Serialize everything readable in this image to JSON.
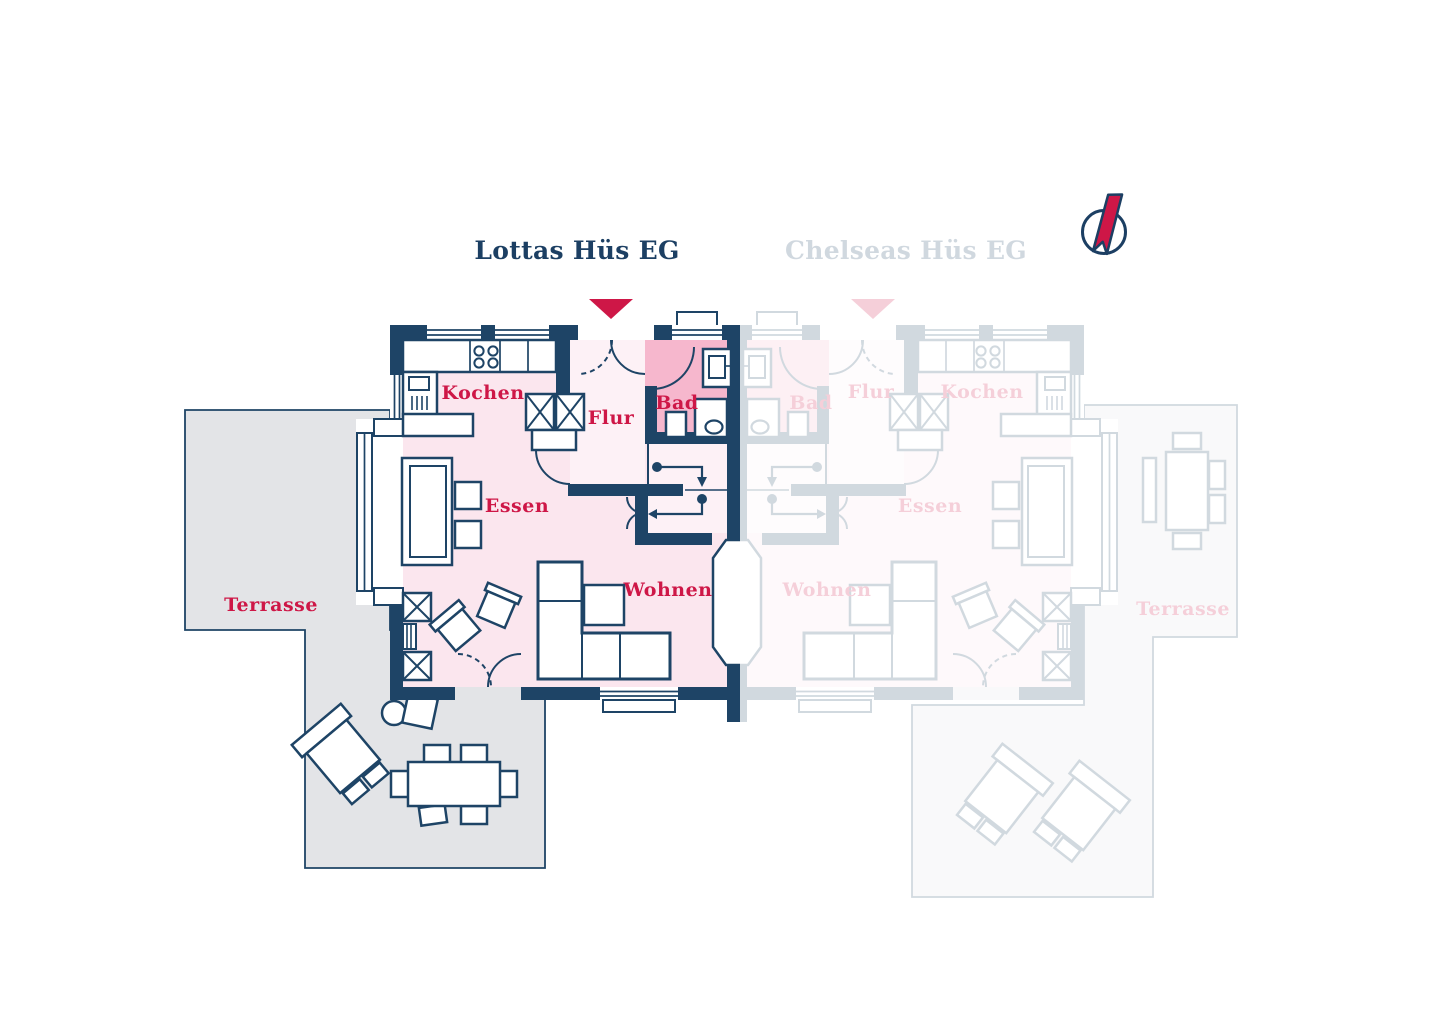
{
  "app": {
    "type": "floorplan-viewer"
  },
  "plans": [
    {
      "id": "lottas",
      "title": "Lottas Hüs EG",
      "state": "active",
      "labels": {
        "kochen": "Kochen",
        "flur": "Flur",
        "bad": "Bad",
        "essen": "Essen",
        "wohnen": "Wohnen",
        "terrasse": "Terrasse"
      }
    },
    {
      "id": "chelseas",
      "title": "Chelseas Hüs EG",
      "state": "inactive",
      "labels": {
        "kochen": "Kochen",
        "flur": "Flur",
        "bad": "Bad",
        "essen": "Essen",
        "wohnen": "Wohnen",
        "terrasse": "Terrasse"
      }
    }
  ],
  "icons": {
    "compass": "compass-needle",
    "entrance_marker": "triangle-down"
  },
  "colors": {
    "wall_navy": "#1e4466",
    "title_navy": "#1c3f63",
    "accent_crimson": "#ce1747",
    "room_pink": "#fbe6ee",
    "hall_pink": "#fdf1f6",
    "bath_pink": "#f6b7cd",
    "terrace_gray": "#e3e4e7",
    "faded_plan_opacity": "0.2"
  }
}
